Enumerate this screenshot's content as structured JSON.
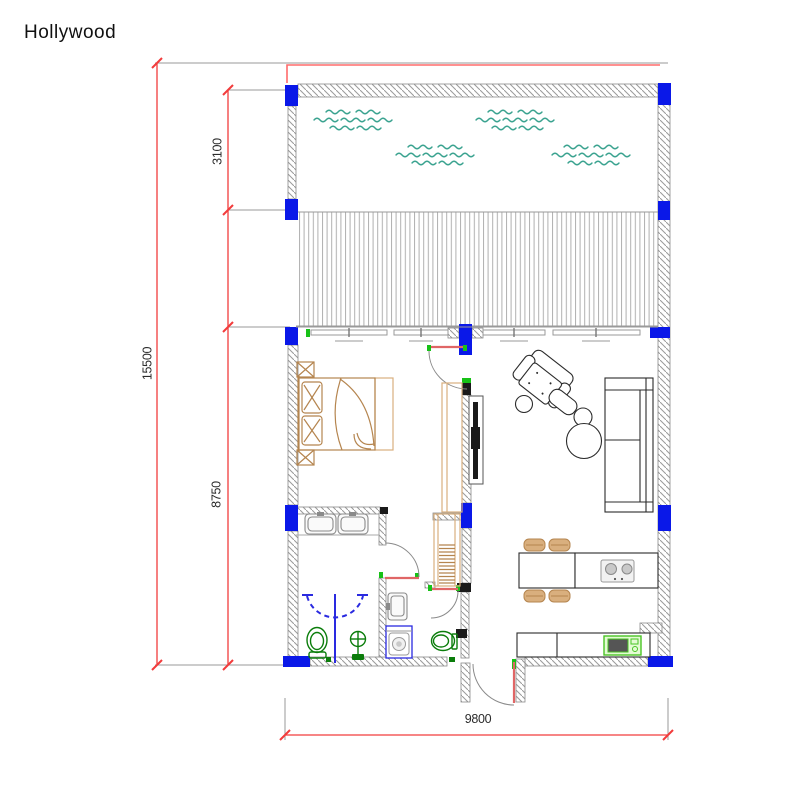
{
  "title": "Hollywood",
  "dimensions": {
    "total_height": "15500",
    "pool_section_depth": "3100",
    "living_section_depth": "8750",
    "total_width": "9800"
  },
  "colors": {
    "dim-red": "#f23c3c",
    "outline-red": "#ff6b6b",
    "ext-gray": "#9a9a9a",
    "wall-stroke": "#8a8a8a",
    "hatch-gray": "#9a9a9a",
    "column-blue": "#0a18e8",
    "water-teal": "#3ba390",
    "furniture-tan": "#b5854f",
    "furniture-tan-light": "#d9af7e",
    "fixture-green": "#0b7d0b",
    "shower-blue": "#2a2ae0",
    "jamb-green": "#17c117",
    "appliance-green": "#49c425",
    "appliance-green-fill": "#e4fbd4",
    "door-leaf-red": "#e06666",
    "ink": "#1a1a1a"
  },
  "icons": {
    "water": "pool-wave-symbol",
    "columns": "structural-column",
    "stairs": "staircase-symbol",
    "shower": "shower-enclosure-symbol"
  }
}
